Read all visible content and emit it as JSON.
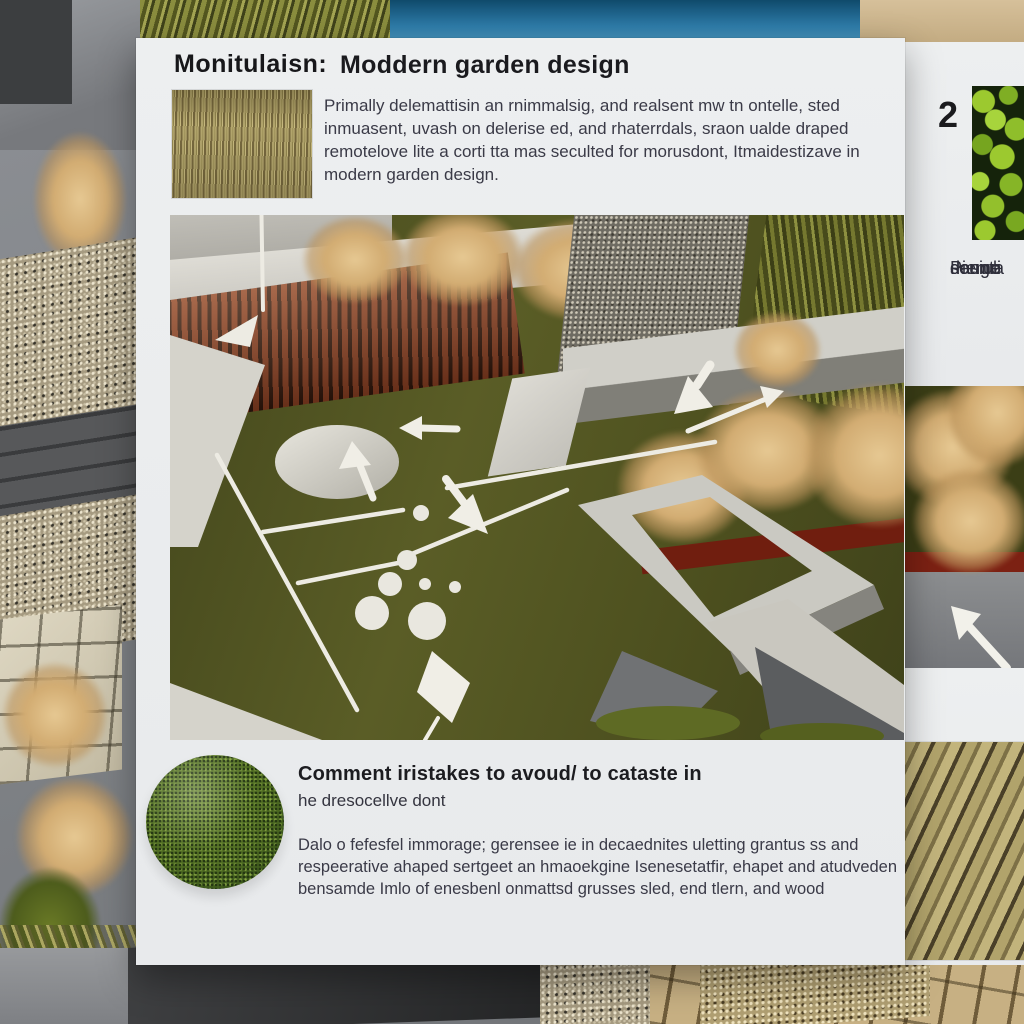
{
  "poster": {
    "header": {
      "label": "Monitulaisn:",
      "title": "Moddern garden design",
      "paragraph": "Primally delemattisin an rnimmalsig, and realsent mw tn ontelle, sted inmuasent, uvash on delerise ed, and rhaterrdals, sraon ualde draped remotelove lite a corti tta mas seculted for morusdont, Itmaidestizave in modern garden design.",
      "swatch_name": "dried-grass-texture"
    },
    "side": {
      "number": "2",
      "photo_name": "green-clover-plants",
      "caption_lines": [
        "Piemo",
        "seunta",
        "donge",
        "dasiuli"
      ]
    },
    "bottom": {
      "photo_name": "round-boxwood-shrub",
      "heading": "Comment iristakes  to avoud/ to cataste in",
      "subheading": "he dresocellve dont",
      "paragraph": "Dalo o fefesfel immorage; gerensee ie in decaednites uletting grantus ss and respeerative ahaped sertgeet an hmaoekgine Isenesetatfir, ehapet and atudveden bensamde Imlo of enesbenl onmattsd grusses sled, end tlern, and wood",
      "side_photo_name": "wood-decking-texture"
    },
    "colors": {
      "panel": "#edeff0",
      "lawn": "#4d501f",
      "deck": "#8a3f22",
      "grass_plume": "#d2ac72",
      "pool": "#2d7aa7",
      "diagram_white": "#edebe3"
    }
  }
}
